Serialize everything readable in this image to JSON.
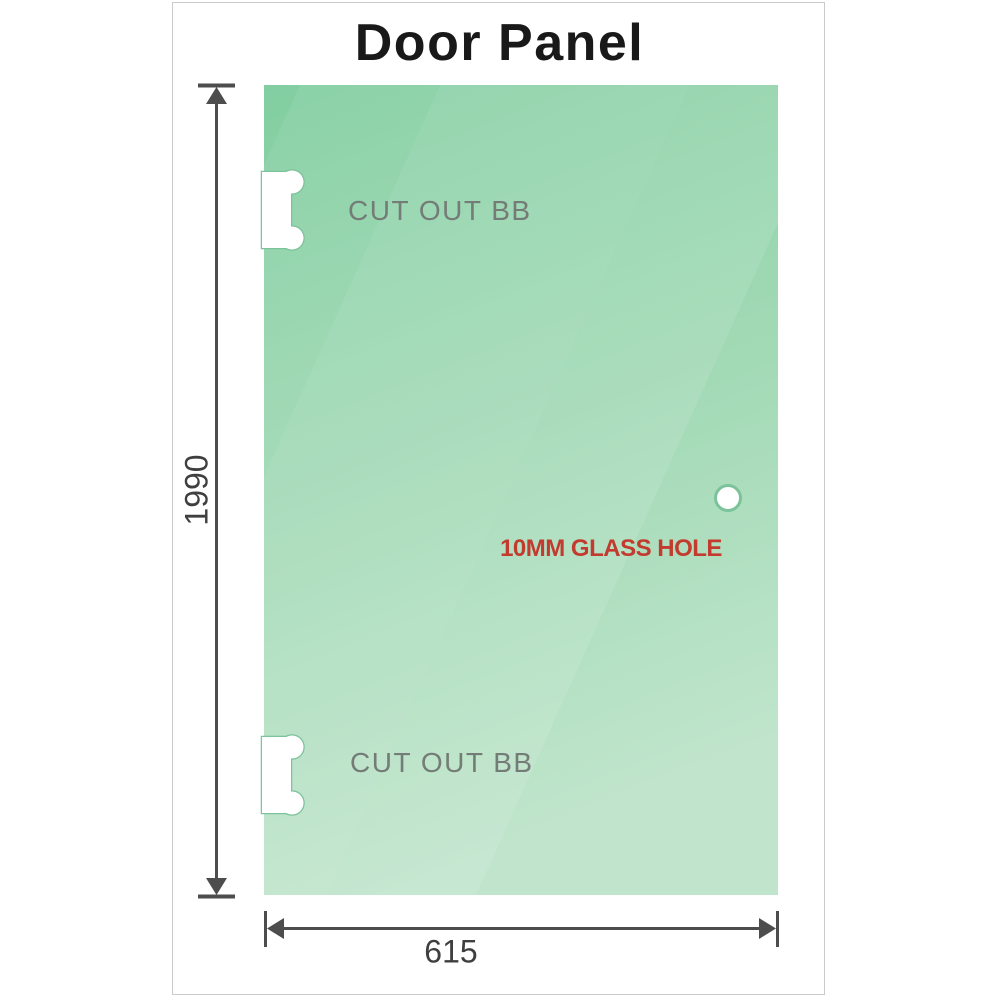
{
  "title": "Door Panel",
  "panel": {
    "cutout_top_label": "CUT OUT BB",
    "cutout_bottom_label": "CUT OUT BB",
    "hole_label": "10MM GLASS HOLE"
  },
  "dimensions": {
    "height_mm": "1990",
    "width_mm": "615"
  },
  "colors": {
    "glass_top": "#82cea1",
    "glass_mid": "#a3dab6",
    "glass_bottom": "#c0e5cc",
    "streak_white": "#ffffff",
    "cutout_fill": "#ffffff",
    "cutout_outline": "#7cc29a",
    "hole_fill": "#ffffff",
    "hole_outline": "#7cc29a",
    "dimension_line": "#4d4d4d",
    "dimension_text": "#3f3f3f",
    "cutout_text": "#747c77",
    "hole_label_color": "#c23b2e",
    "title_color": "#191919",
    "frame_border": "#cacaca",
    "background": "#ffffff"
  }
}
